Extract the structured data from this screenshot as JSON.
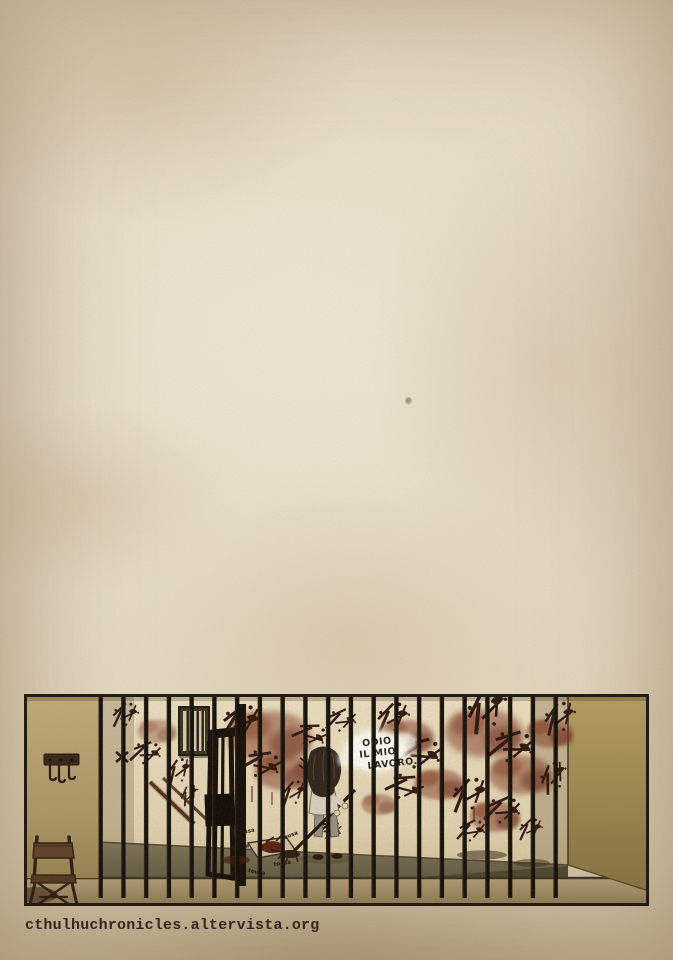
{
  "page": {
    "width_px": 673,
    "height_px": 960,
    "paper_base_color": "#e8dcc6",
    "paper_edge_color": "#ccb995"
  },
  "footer": {
    "site_url": "cthulhuchronicles.altervista.org",
    "text_color": "#33281a"
  },
  "panel": {
    "speech_bubble": {
      "line1": "ODIO",
      "line2": "IL MIO",
      "line3": "LAVORO...",
      "text_color": "#2b241e",
      "glow_color": "#fffdf2"
    },
    "sfx_scribble": "tousa",
    "colors": {
      "border": "#251b10",
      "jail_bars": "#140f08",
      "blood_dark": "#31150c",
      "blood_red": "#7b3a24",
      "left_wall": "#b7a273",
      "back_wall": "#e7dabc",
      "right_wall": "#a28d54",
      "cell_floor": "#6f6650",
      "corridor_floor": "#a18d67",
      "door": "#140d07",
      "wood": "#4a3422"
    }
  }
}
